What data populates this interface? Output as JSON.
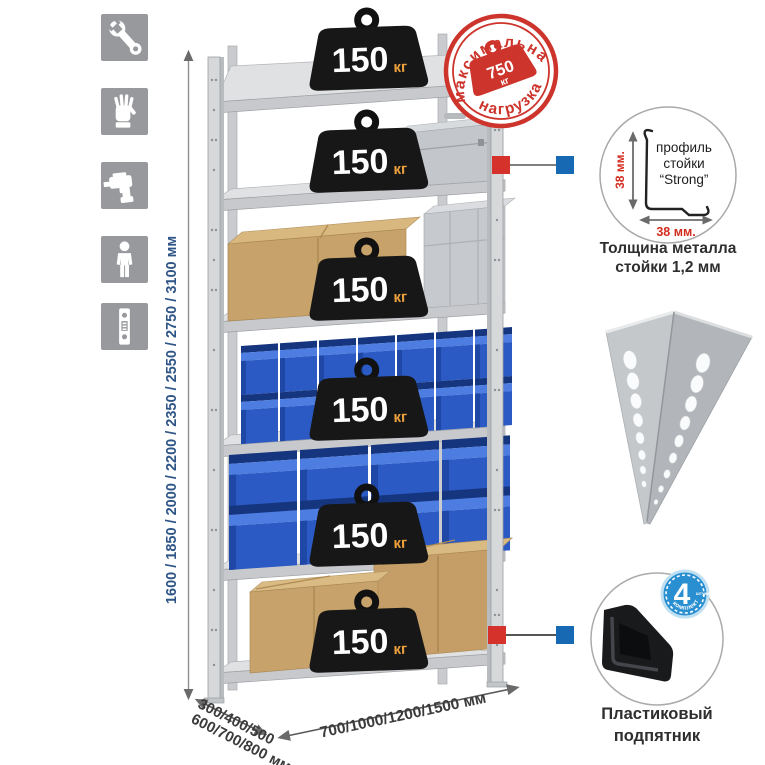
{
  "colors": {
    "stamp_red": "#cd342c",
    "marker_red": "#d4322a",
    "marker_blue": "#1769b3",
    "badge_blue": "#2a8fd0",
    "bin_blue": "#2b5ac4",
    "height_text_blue": "#2f5586",
    "weight_unit_orange": "#efa23c"
  },
  "left_icons": [
    {
      "name": "wrench-icon"
    },
    {
      "name": "gloves-icon"
    },
    {
      "name": "drill-icon"
    },
    {
      "name": "person-icon"
    },
    {
      "name": "rack-post-icon"
    }
  ],
  "dimensions": {
    "height": "1600 / 1850 / 2000 / 2200 / 2350 / 2550 / 2750 / 3100 мм",
    "depth_line1": "300/400/500",
    "depth_line2": "600/700/800 мм",
    "width": "700/1000/1200/1500 мм"
  },
  "rack": {
    "shelf_count": 6,
    "per_shelf_load": {
      "value": "150",
      "unit": "кг"
    }
  },
  "stamp": {
    "top": "максимальная",
    "bottom": "нагрузка",
    "value": "750",
    "unit": "кг"
  },
  "profile": {
    "label_line1": "профиль",
    "label_line2": "стойки",
    "label_line3": "“Strong”",
    "dim_vertical": "38 мм.",
    "dim_horizontal": "38 мм.",
    "caption_line1": "Толщина металла",
    "caption_line2": "стойки 1,2 мм"
  },
  "foot": {
    "badge_value": "4",
    "badge_unit": "штуки",
    "badge_arc": "в комплекте",
    "caption_line1": "Пластиковый",
    "caption_line2": "подпятник"
  }
}
